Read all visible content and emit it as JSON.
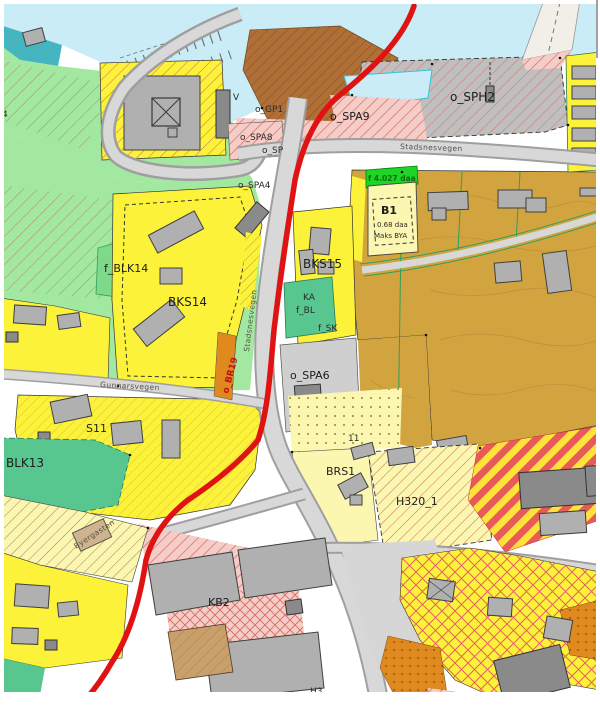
{
  "map": {
    "labels": {
      "four": "4",
      "v": "V",
      "gp": "o_GP1",
      "spa8": "o_SPA8",
      "sp": "o_SP",
      "spa4": "o_SPA4",
      "spa9": "o_SPA9",
      "sph2": "o_SPH2",
      "area_b1": "f 4.027 daa",
      "b1": "B1",
      "b1_daa": "0.68 daa",
      "b1_bya": "Maks BYA",
      "bks15": "BKS15",
      "blk14": "f_BLK14",
      "bks14": "BKS14",
      "ka": "KA",
      "fbl": "f_BL",
      "fsk": "f_SK",
      "spa6": "o_SPA6",
      "br19": "o_BR19",
      "blk13": "BLK13",
      "s11": "S11",
      "n11": "11",
      "brs1": "BRS1",
      "h320": "H320_1",
      "kb2": "KB2",
      "h3": "H3"
    },
    "streets": {
      "stadsnesvegen": "Stadsnesvegen",
      "stadsnesvegen_v": "Stadsnesvegen",
      "gunnarsvegen": "Gunnarsvegen",
      "byergasten": "Byergasten"
    },
    "colors": {
      "route_red": "#e01212",
      "water": "#c9ecf6",
      "residential_yellow": "#fdf23a",
      "existing_area_ochre": "#d2a440",
      "green_area": "#a2e8a0",
      "road_gray": "#d8d8d8",
      "hazard_hatch_red": "#d96a5f",
      "building_gray": "#b0b0b0"
    }
  }
}
